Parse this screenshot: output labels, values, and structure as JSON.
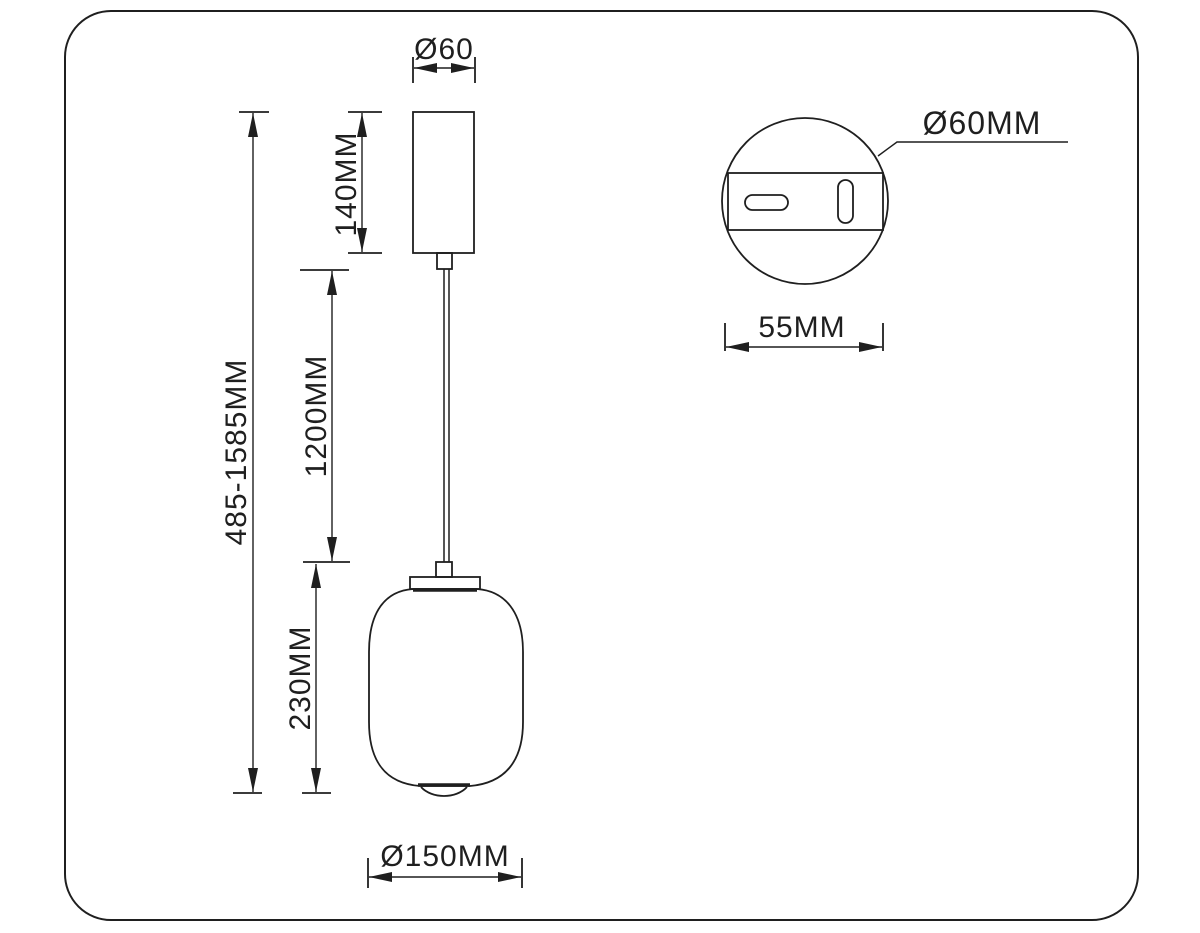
{
  "drawing": {
    "background": "#ffffff",
    "line_color": "#1f1f1f",
    "front_view": {
      "top_diameter_label": "Ø60",
      "overall_height_label": "485-1585MM",
      "canopy_height_label": "140MM",
      "cable_length_label": "1200MM",
      "shade_height_label": "230MM",
      "shade_diameter_label": "Ø150MM"
    },
    "detail_view": {
      "canopy_diameter_label": "Ø60MM",
      "plate_width_label": "55MM"
    }
  }
}
